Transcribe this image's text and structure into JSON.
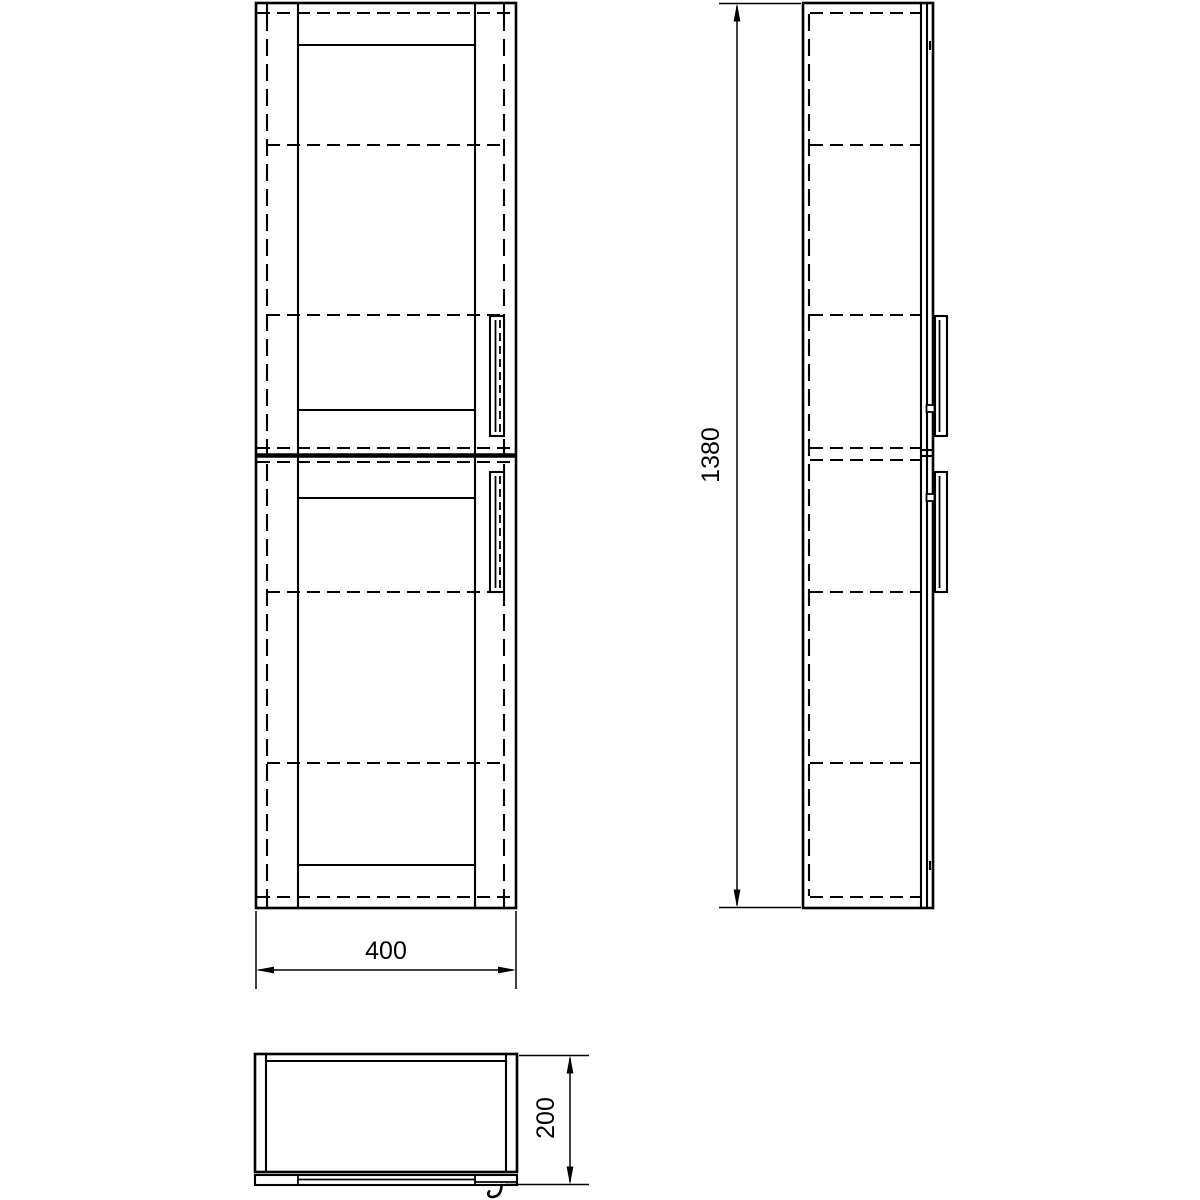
{
  "drawing": {
    "description": "tall two-door cabinet technical drawing with front, side and plan views",
    "dimension_labels": {
      "width": "400",
      "height": "1380",
      "depth": "200"
    },
    "line_color": "#000000",
    "background_color": "#ffffff"
  }
}
